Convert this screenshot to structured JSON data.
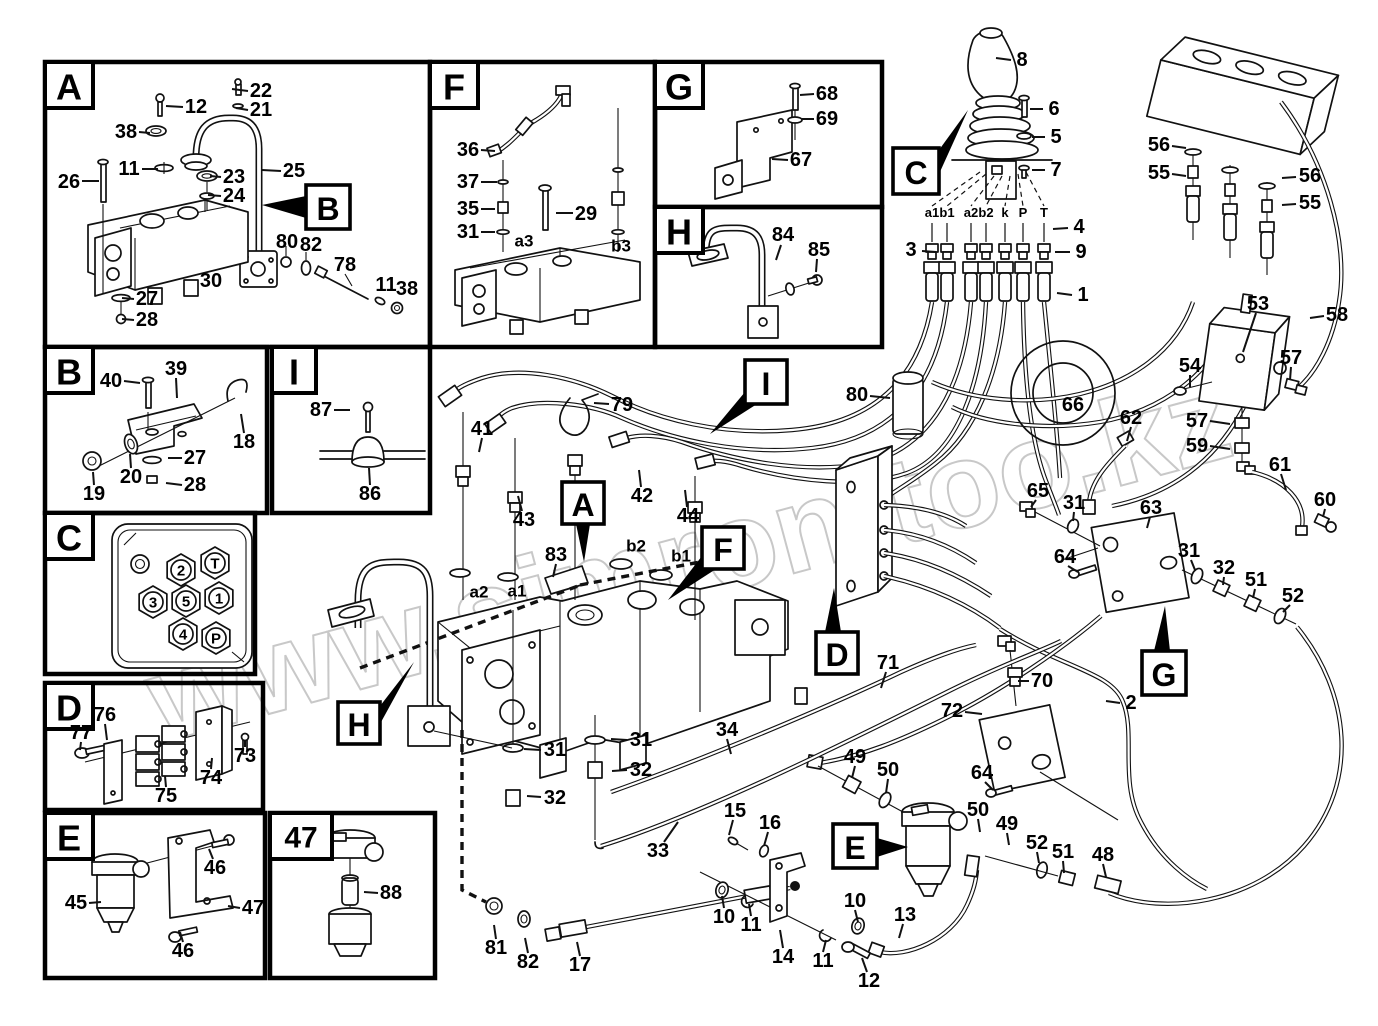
{
  "title": "Hydraulic system parts diagram",
  "watermark": {
    "text": "www.simron-too.kz",
    "color": "#c3c3c3"
  },
  "panels": [
    {
      "id": "A",
      "letter": "A",
      "x": 45,
      "y": 62,
      "w": 385,
      "h": 285,
      "lw": 48
    },
    {
      "id": "F",
      "letter": "F",
      "x": 430,
      "y": 62,
      "w": 225,
      "h": 285,
      "lw": 48
    },
    {
      "id": "G",
      "letter": "G",
      "x": 655,
      "y": 62,
      "w": 227,
      "h": 145,
      "lw": 48
    },
    {
      "id": "H",
      "letter": "H",
      "x": 655,
      "y": 207,
      "w": 227,
      "h": 140,
      "lw": 48
    },
    {
      "id": "B",
      "letter": "B",
      "x": 45,
      "y": 347,
      "w": 222,
      "h": 166,
      "lw": 48
    },
    {
      "id": "I",
      "letter": "I",
      "x": 272,
      "y": 347,
      "w": 158,
      "h": 166,
      "lw": 44
    },
    {
      "id": "C",
      "letter": "C",
      "x": 45,
      "y": 513,
      "w": 210,
      "h": 161,
      "lw": 48
    },
    {
      "id": "D",
      "letter": "D",
      "x": 45,
      "y": 683,
      "w": 218,
      "h": 127,
      "lw": 48
    },
    {
      "id": "E",
      "letter": "E",
      "x": 45,
      "y": 813,
      "w": 220,
      "h": 165,
      "lw": 48
    },
    {
      "id": "47",
      "letter": "47",
      "x": 270,
      "y": 813,
      "w": 165,
      "h": 165,
      "lw": 62
    }
  ],
  "callouts": [
    {
      "letter": "B",
      "x": 306,
      "y": 185,
      "w": 44,
      "h": 44,
      "arrow": [
        306,
        196,
        306,
        218,
        262,
        205
      ]
    },
    {
      "letter": "C",
      "x": 893,
      "y": 148,
      "w": 46,
      "h": 46,
      "arrow": [
        939,
        150,
        939,
        174,
        968,
        110
      ]
    },
    {
      "letter": "A",
      "x": 562,
      "y": 482,
      "w": 42,
      "h": 42,
      "arrow": [
        576,
        524,
        590,
        524,
        584,
        562
      ]
    },
    {
      "letter": "F",
      "x": 702,
      "y": 527,
      "w": 42,
      "h": 42,
      "arrow": [
        702,
        556,
        716,
        569,
        668,
        600
      ]
    },
    {
      "letter": "I",
      "x": 745,
      "y": 360,
      "w": 42,
      "h": 44,
      "arrow": [
        745,
        392,
        757,
        404,
        710,
        434
      ]
    },
    {
      "letter": "H",
      "x": 338,
      "y": 702,
      "w": 42,
      "h": 42,
      "arrow": [
        380,
        706,
        380,
        724,
        414,
        662
      ]
    },
    {
      "letter": "D",
      "x": 816,
      "y": 632,
      "w": 42,
      "h": 42,
      "arrow": [
        825,
        632,
        841,
        632,
        834,
        588
      ]
    },
    {
      "letter": "E",
      "x": 833,
      "y": 824,
      "w": 44,
      "h": 44,
      "arrow": [
        877,
        838,
        877,
        857,
        908,
        847
      ]
    },
    {
      "letter": "G",
      "x": 1142,
      "y": 651,
      "w": 44,
      "h": 44,
      "arrow": [
        1154,
        651,
        1170,
        651,
        1165,
        606
      ]
    }
  ],
  "joystick_ports": {
    "y": 217,
    "items": [
      {
        "t": "a1",
        "x": 932
      },
      {
        "t": "b1",
        "x": 947
      },
      {
        "t": "a2",
        "x": 971
      },
      {
        "t": "b2",
        "x": 986
      },
      {
        "t": "k",
        "x": 1005
      },
      {
        "t": "P",
        "x": 1023
      },
      {
        "t": "T",
        "x": 1044
      }
    ]
  },
  "c_panel_ports": [
    {
      "t": "2",
      "x": 181,
      "y": 570
    },
    {
      "t": "T",
      "x": 215,
      "y": 563
    },
    {
      "t": "3",
      "x": 153,
      "y": 602
    },
    {
      "t": "5",
      "x": 186,
      "y": 601
    },
    {
      "t": "1",
      "x": 219,
      "y": 598
    },
    {
      "t": "4",
      "x": 183,
      "y": 634
    },
    {
      "t": "P",
      "x": 216,
      "y": 638
    }
  ],
  "labels": [
    {
      "t": "22",
      "x": 261,
      "y": 91,
      "l": [
        248,
        91,
        232,
        89
      ]
    },
    {
      "t": "21",
      "x": 261,
      "y": 110,
      "l": [
        248,
        110,
        236,
        108
      ]
    },
    {
      "t": "12",
      "x": 196,
      "y": 107,
      "l": [
        183,
        107,
        166,
        106
      ]
    },
    {
      "t": "38",
      "x": 126,
      "y": 132,
      "l": [
        139,
        132,
        150,
        133
      ]
    },
    {
      "t": "11",
      "x": 129,
      "y": 169,
      "l": [
        142,
        169,
        158,
        169
      ]
    },
    {
      "t": "26",
      "x": 69,
      "y": 182,
      "l": [
        82,
        181,
        99,
        181
      ]
    },
    {
      "t": "23",
      "x": 234,
      "y": 177,
      "l": [
        221,
        177,
        210,
        176
      ]
    },
    {
      "t": "24",
      "x": 234,
      "y": 196,
      "l": [
        221,
        196,
        208,
        195
      ]
    },
    {
      "t": "25",
      "x": 294,
      "y": 171,
      "l": [
        281,
        171,
        262,
        170
      ]
    },
    {
      "t": "80",
      "x": 287,
      "y": 242
    },
    {
      "t": "82",
      "x": 311,
      "y": 245
    },
    {
      "t": "78",
      "x": 345,
      "y": 265
    },
    {
      "t": "11",
      "x": 386,
      "y": 285
    },
    {
      "t": "38",
      "x": 407,
      "y": 289
    },
    {
      "t": "27",
      "x": 147,
      "y": 299,
      "l": [
        134,
        299,
        122,
        298
      ]
    },
    {
      "t": "28",
      "x": 147,
      "y": 320,
      "l": [
        134,
        320,
        122,
        319
      ]
    },
    {
      "t": "30",
      "x": 211,
      "y": 281
    },
    {
      "t": "36",
      "x": 468,
      "y": 150,
      "l": [
        481,
        150,
        495,
        151
      ]
    },
    {
      "t": "37",
      "x": 468,
      "y": 182,
      "l": [
        481,
        182,
        497,
        182
      ]
    },
    {
      "t": "35",
      "x": 468,
      "y": 209,
      "l": [
        481,
        209,
        495,
        209
      ]
    },
    {
      "t": "31",
      "x": 468,
      "y": 232,
      "l": [
        481,
        232,
        495,
        232
      ]
    },
    {
      "t": "a3",
      "x": 524,
      "y": 241,
      "s": 17
    },
    {
      "t": "29",
      "x": 586,
      "y": 214,
      "l": [
        573,
        213,
        556,
        213
      ]
    },
    {
      "t": "b3",
      "x": 621,
      "y": 246,
      "s": 17
    },
    {
      "t": "68",
      "x": 827,
      "y": 94,
      "l": [
        814,
        94,
        800,
        95
      ]
    },
    {
      "t": "69",
      "x": 827,
      "y": 119,
      "l": [
        814,
        119,
        802,
        119
      ]
    },
    {
      "t": "67",
      "x": 801,
      "y": 160,
      "l": [
        788,
        160,
        772,
        159
      ]
    },
    {
      "t": "84",
      "x": 783,
      "y": 235,
      "l": [
        781,
        245,
        776,
        260
      ]
    },
    {
      "t": "85",
      "x": 819,
      "y": 250,
      "l": [
        817,
        259,
        816,
        272
      ]
    },
    {
      "t": "40",
      "x": 111,
      "y": 381,
      "l": [
        124,
        381,
        140,
        383
      ]
    },
    {
      "t": "39",
      "x": 176,
      "y": 369,
      "l": [
        176,
        378,
        177,
        398
      ]
    },
    {
      "t": "18",
      "x": 244,
      "y": 442,
      "l": [
        244,
        433,
        241,
        414
      ]
    },
    {
      "t": "27",
      "x": 195,
      "y": 458,
      "l": [
        182,
        458,
        168,
        458
      ]
    },
    {
      "t": "28",
      "x": 195,
      "y": 485,
      "l": [
        182,
        485,
        166,
        483
      ]
    },
    {
      "t": "20",
      "x": 131,
      "y": 477,
      "l": [
        131,
        468,
        130,
        454
      ]
    },
    {
      "t": "19",
      "x": 94,
      "y": 494,
      "l": [
        94,
        485,
        93,
        472
      ]
    },
    {
      "t": "87",
      "x": 321,
      "y": 410,
      "l": [
        334,
        410,
        350,
        410
      ]
    },
    {
      "t": "86",
      "x": 370,
      "y": 494,
      "l": [
        370,
        485,
        369,
        468
      ]
    },
    {
      "t": "76",
      "x": 105,
      "y": 715,
      "l": [
        105,
        724,
        107,
        740
      ]
    },
    {
      "t": "77",
      "x": 81,
      "y": 733,
      "l": [
        81,
        742,
        80,
        750
      ]
    },
    {
      "t": "75",
      "x": 166,
      "y": 796,
      "l": [
        166,
        787,
        165,
        776
      ]
    },
    {
      "t": "74",
      "x": 211,
      "y": 778,
      "l": [
        211,
        769,
        212,
        758
      ]
    },
    {
      "t": "73",
      "x": 245,
      "y": 756,
      "l": [
        245,
        747,
        245,
        740
      ]
    },
    {
      "t": "45",
      "x": 76,
      "y": 903,
      "l": [
        89,
        903,
        101,
        902
      ]
    },
    {
      "t": "46",
      "x": 215,
      "y": 868,
      "l": [
        213,
        859,
        209,
        849
      ]
    },
    {
      "t": "47",
      "x": 253,
      "y": 908,
      "l": [
        240,
        908,
        228,
        906
      ]
    },
    {
      "t": "46",
      "x": 183,
      "y": 951,
      "l": [
        183,
        942,
        180,
        932
      ]
    },
    {
      "t": "88",
      "x": 391,
      "y": 893,
      "l": [
        378,
        893,
        364,
        892
      ]
    },
    {
      "t": "8",
      "x": 1022,
      "y": 60,
      "l": [
        1011,
        60,
        996,
        58
      ]
    },
    {
      "t": "6",
      "x": 1054,
      "y": 109,
      "l": [
        1043,
        109,
        1030,
        109
      ]
    },
    {
      "t": "5",
      "x": 1056,
      "y": 137,
      "l": [
        1045,
        137,
        1032,
        137
      ]
    },
    {
      "t": "7",
      "x": 1056,
      "y": 170,
      "l": [
        1045,
        170,
        1032,
        170
      ]
    },
    {
      "t": "4",
      "x": 1079,
      "y": 227,
      "l": [
        1068,
        228,
        1053,
        229
      ]
    },
    {
      "t": "3",
      "x": 911,
      "y": 250,
      "l": [
        922,
        251,
        936,
        252
      ]
    },
    {
      "t": "9",
      "x": 1081,
      "y": 252,
      "l": [
        1070,
        252,
        1055,
        252
      ]
    },
    {
      "t": "1",
      "x": 1083,
      "y": 295,
      "l": [
        1072,
        295,
        1057,
        293
      ]
    },
    {
      "t": "56",
      "x": 1159,
      "y": 145,
      "l": [
        1172,
        146,
        1186,
        148
      ]
    },
    {
      "t": "55",
      "x": 1159,
      "y": 173,
      "l": [
        1172,
        174,
        1186,
        176
      ]
    },
    {
      "t": "56",
      "x": 1310,
      "y": 176,
      "l": [
        1296,
        177,
        1282,
        178
      ]
    },
    {
      "t": "55",
      "x": 1310,
      "y": 203,
      "l": [
        1296,
        204,
        1282,
        205
      ]
    },
    {
      "t": "53",
      "x": 1258,
      "y": 304,
      "l": [
        1256,
        313,
        1243,
        352
      ]
    },
    {
      "t": "58",
      "x": 1337,
      "y": 315,
      "l": [
        1324,
        316,
        1310,
        318
      ]
    },
    {
      "t": "57",
      "x": 1291,
      "y": 358,
      "l": [
        1291,
        367,
        1290,
        380
      ]
    },
    {
      "t": "54",
      "x": 1190,
      "y": 366,
      "l": [
        1190,
        375,
        1190,
        387
      ]
    },
    {
      "t": "66",
      "x": 1073,
      "y": 405
    },
    {
      "t": "62",
      "x": 1131,
      "y": 418,
      "l": [
        1131,
        427,
        1127,
        441
      ]
    },
    {
      "t": "57",
      "x": 1197,
      "y": 421,
      "l": [
        1210,
        421,
        1230,
        424
      ]
    },
    {
      "t": "59",
      "x": 1197,
      "y": 446,
      "l": [
        1210,
        446,
        1230,
        449
      ]
    },
    {
      "t": "61",
      "x": 1280,
      "y": 465,
      "l": [
        1281,
        474,
        1286,
        490
      ]
    },
    {
      "t": "60",
      "x": 1325,
      "y": 500,
      "l": [
        1325,
        509,
        1323,
        517
      ]
    },
    {
      "t": "80",
      "x": 857,
      "y": 395,
      "l": [
        870,
        396,
        890,
        398
      ]
    },
    {
      "t": "65",
      "x": 1038,
      "y": 491,
      "l": [
        1036,
        500,
        1031,
        507
      ]
    },
    {
      "t": "31",
      "x": 1074,
      "y": 503,
      "l": [
        1074,
        512,
        1073,
        521
      ]
    },
    {
      "t": "64",
      "x": 1065,
      "y": 557,
      "l": [
        1068,
        566,
        1078,
        572
      ]
    },
    {
      "t": "63",
      "x": 1151,
      "y": 508,
      "l": [
        1150,
        517,
        1147,
        528
      ]
    },
    {
      "t": "31",
      "x": 1189,
      "y": 551,
      "l": [
        1191,
        560,
        1195,
        570
      ]
    },
    {
      "t": "32",
      "x": 1224,
      "y": 568,
      "l": [
        1224,
        577,
        1223,
        585
      ]
    },
    {
      "t": "51",
      "x": 1256,
      "y": 580,
      "l": [
        1255,
        589,
        1253,
        598
      ]
    },
    {
      "t": "52",
      "x": 1293,
      "y": 596,
      "l": [
        1290,
        605,
        1283,
        612
      ]
    },
    {
      "t": "79",
      "x": 622,
      "y": 405,
      "l": [
        609,
        404,
        594,
        403
      ]
    },
    {
      "t": "41",
      "x": 482,
      "y": 429,
      "l": [
        482,
        438,
        479,
        452
      ]
    },
    {
      "t": "43",
      "x": 524,
      "y": 520,
      "l": [
        522,
        511,
        518,
        496
      ]
    },
    {
      "t": "42",
      "x": 642,
      "y": 496,
      "l": [
        641,
        487,
        639,
        470
      ]
    },
    {
      "t": "44",
      "x": 688,
      "y": 516,
      "l": [
        687,
        507,
        685,
        490
      ]
    },
    {
      "t": "83",
      "x": 556,
      "y": 555,
      "l": [
        556,
        564,
        553,
        577
      ]
    },
    {
      "t": "b2",
      "x": 636,
      "y": 546,
      "s": 17
    },
    {
      "t": "b1",
      "x": 681,
      "y": 556,
      "s": 17
    },
    {
      "t": "a2",
      "x": 479,
      "y": 592,
      "s": 17
    },
    {
      "t": "a1",
      "x": 517,
      "y": 591,
      "s": 17
    },
    {
      "t": "31",
      "x": 555,
      "y": 750,
      "l": [
        541,
        750,
        524,
        749
      ]
    },
    {
      "t": "32",
      "x": 555,
      "y": 798,
      "l": [
        541,
        797,
        527,
        796
      ]
    },
    {
      "t": "31",
      "x": 641,
      "y": 740,
      "l": [
        627,
        740,
        611,
        739
      ]
    },
    {
      "t": "32",
      "x": 641,
      "y": 770,
      "l": [
        627,
        770,
        612,
        771
      ]
    },
    {
      "t": "34",
      "x": 727,
      "y": 730,
      "l": [
        727,
        739,
        731,
        754
      ]
    },
    {
      "t": "33",
      "x": 658,
      "y": 851,
      "l": [
        664,
        842,
        678,
        822
      ]
    },
    {
      "t": "15",
      "x": 735,
      "y": 811,
      "l": [
        733,
        820,
        729,
        835
      ]
    },
    {
      "t": "16",
      "x": 770,
      "y": 823,
      "l": [
        768,
        832,
        764,
        846
      ]
    },
    {
      "t": "10",
      "x": 724,
      "y": 917,
      "l": [
        724,
        908,
        722,
        896
      ]
    },
    {
      "t": "11",
      "x": 751,
      "y": 925,
      "l": [
        751,
        916,
        749,
        904
      ]
    },
    {
      "t": "14",
      "x": 783,
      "y": 957,
      "l": [
        783,
        948,
        780,
        930
      ]
    },
    {
      "t": "10",
      "x": 855,
      "y": 901,
      "l": [
        855,
        910,
        858,
        922
      ]
    },
    {
      "t": "11",
      "x": 823,
      "y": 961,
      "l": [
        823,
        952,
        826,
        940
      ]
    },
    {
      "t": "12",
      "x": 869,
      "y": 981,
      "l": [
        867,
        972,
        862,
        958
      ]
    },
    {
      "t": "13",
      "x": 905,
      "y": 915,
      "l": [
        903,
        924,
        899,
        938
      ]
    },
    {
      "t": "81",
      "x": 496,
      "y": 948,
      "l": [
        496,
        939,
        494,
        925
      ]
    },
    {
      "t": "82",
      "x": 528,
      "y": 962,
      "l": [
        528,
        953,
        525,
        938
      ]
    },
    {
      "t": "17",
      "x": 580,
      "y": 965,
      "l": [
        580,
        956,
        577,
        942
      ]
    },
    {
      "t": "71",
      "x": 888,
      "y": 663,
      "l": [
        886,
        672,
        881,
        688
      ]
    },
    {
      "t": "72",
      "x": 952,
      "y": 711,
      "l": [
        965,
        712,
        982,
        714
      ]
    },
    {
      "t": "70",
      "x": 1042,
      "y": 681,
      "l": [
        1029,
        681,
        1018,
        681
      ]
    },
    {
      "t": "2",
      "x": 1131,
      "y": 703,
      "l": [
        1120,
        703,
        1106,
        701
      ]
    },
    {
      "t": "64",
      "x": 982,
      "y": 773,
      "l": [
        985,
        782,
        993,
        790
      ]
    },
    {
      "t": "49",
      "x": 855,
      "y": 757,
      "l": [
        855,
        766,
        852,
        778
      ]
    },
    {
      "t": "50",
      "x": 888,
      "y": 770,
      "l": [
        888,
        779,
        886,
        793
      ]
    },
    {
      "t": "50",
      "x": 978,
      "y": 810,
      "l": [
        978,
        819,
        980,
        832
      ]
    },
    {
      "t": "49",
      "x": 1007,
      "y": 824,
      "l": [
        1007,
        833,
        1009,
        845
      ]
    },
    {
      "t": "52",
      "x": 1037,
      "y": 843,
      "l": [
        1037,
        852,
        1039,
        863
      ]
    },
    {
      "t": "51",
      "x": 1063,
      "y": 852,
      "l": [
        1063,
        861,
        1064,
        873
      ]
    },
    {
      "t": "48",
      "x": 1103,
      "y": 855,
      "l": [
        1103,
        864,
        1106,
        877
      ]
    }
  ]
}
